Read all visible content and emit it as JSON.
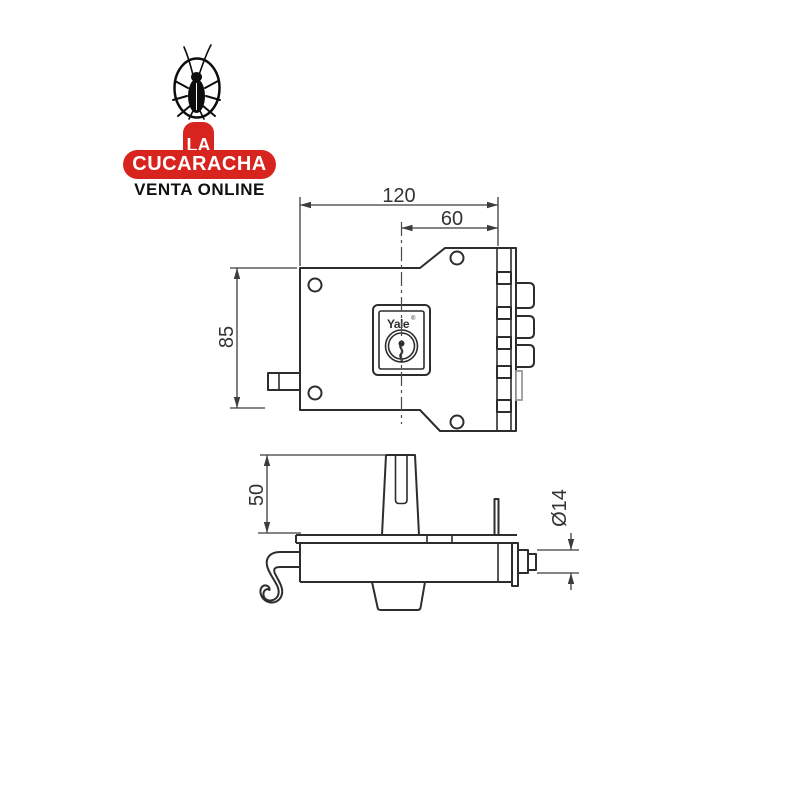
{
  "page": {
    "background": "#ffffff"
  },
  "logo": {
    "la": "LA",
    "name": "CUCARACHA",
    "tagline": "VENTA ONLINE",
    "badge_color": "#d7241f",
    "tagline_color": "#111111",
    "text_color": "#ffffff",
    "icon": "cockroach-in-oval"
  },
  "drawing": {
    "brand": "Yale",
    "registered_mark": "®",
    "line_color": "#2d2d2d",
    "dimension_color": "#3c3c3c",
    "dimensions": {
      "body_width": "120",
      "cylinder_offset": "60",
      "body_height": "85",
      "follower_height": "50",
      "bolt_diameter": "Ø14"
    }
  }
}
